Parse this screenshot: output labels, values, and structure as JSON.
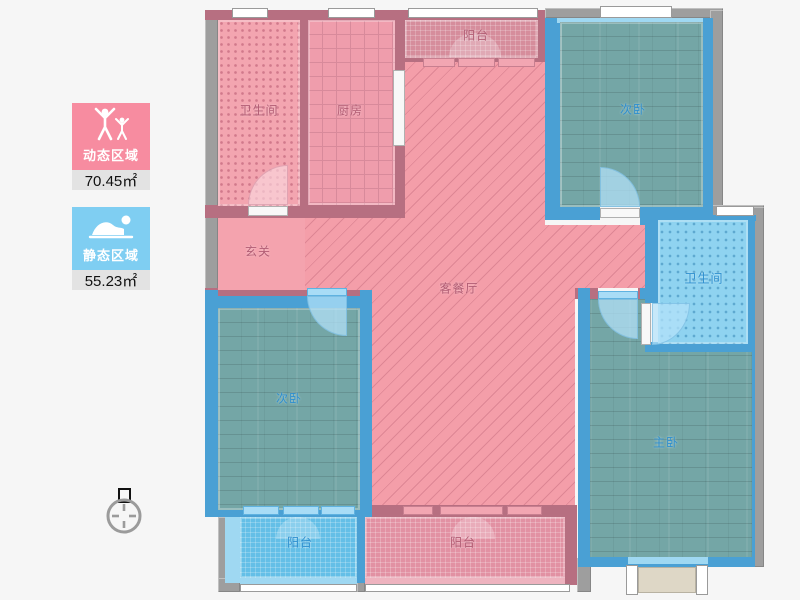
{
  "legend": {
    "dynamic": {
      "label": "动态区域",
      "area": "70.45㎡",
      "color": "#f78ca0",
      "icon": "people-arms-raised-icon"
    },
    "static": {
      "label": "静态区域",
      "area": "55.23㎡",
      "color": "#7fcef2",
      "icon": "person-sleeping-icon"
    }
  },
  "floorplan": {
    "rooms": [
      {
        "name": "bathroom-top",
        "label": "卫生间",
        "zone": "dynamic"
      },
      {
        "name": "kitchen",
        "label": "厨房",
        "zone": "dynamic"
      },
      {
        "name": "balcony-top",
        "label": "阳台",
        "zone": "dynamic"
      },
      {
        "name": "bedroom-top-right",
        "label": "次卧",
        "zone": "static"
      },
      {
        "name": "bathroom-right",
        "label": "卫生间",
        "zone": "static"
      },
      {
        "name": "entry-hall",
        "label": "玄关",
        "zone": "dynamic"
      },
      {
        "name": "living-dining",
        "label": "客餐厅",
        "zone": "dynamic"
      },
      {
        "name": "bedroom-left",
        "label": "次卧",
        "zone": "static"
      },
      {
        "name": "master-bedroom",
        "label": "主卧",
        "zone": "static"
      },
      {
        "name": "balcony-bottom-left",
        "label": "阳台",
        "zone": "static"
      },
      {
        "name": "balcony-bottom-center",
        "label": "阳台",
        "zone": "dynamic"
      }
    ]
  },
  "colors": {
    "dynamic_fill": "#f49ea9",
    "static_floor": "#74a6a6",
    "wall_pink": "#b76f81",
    "wall_blue": "#4aa0d4",
    "wall_gray": "#9e9e9e",
    "label_pink": "#b25d74",
    "label_blue": "#2e8fcf",
    "background": "#f6f6f6"
  },
  "compass": {
    "name": "north-indicator"
  }
}
